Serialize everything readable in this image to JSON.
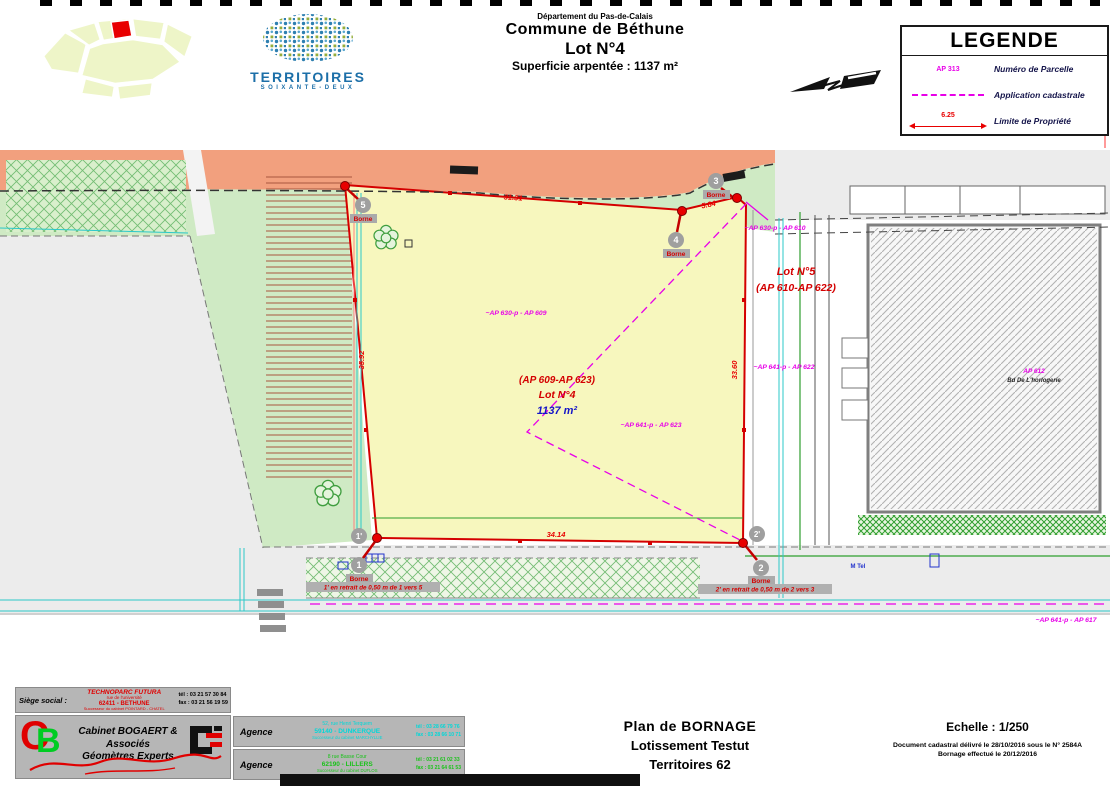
{
  "header": {
    "department": "Département du Pas-de-Calais",
    "commune": "Commune de Béthune",
    "lot": "Lot N°4",
    "area": "Superficie arpentée : 1137 m²"
  },
  "logo": {
    "title": "TERRITOIRES",
    "subtitle": "SOIXANTE-DEUX"
  },
  "legend": {
    "title": "LEGENDE",
    "parcel_symbol": "AP 313",
    "limit_value": "6.25",
    "items": [
      {
        "label": "Numéro de Parcelle"
      },
      {
        "label": "Application cadastrale"
      },
      {
        "label": "Limite de Propriété"
      }
    ]
  },
  "plan": {
    "lot4": {
      "parcels": "(AP 609-AP 623)",
      "name": "Lot N°4",
      "area": "1137 m²"
    },
    "lot5": {
      "name": "Lot N°5",
      "parcels": "(AP 610-AP 622)"
    },
    "labels": {
      "ap630_609": "~AP 630-p - AP 609",
      "ap641_623": "~AP 641-p - AP 623",
      "ap630_610": "~AP 630-p - AP 610",
      "ap641_622": "~AP 641-p - AP 622",
      "ap641_617": "~AP 641-p - AP 617",
      "ap612": "AP 612",
      "building_name": "Bd De L'horlogerie",
      "tel": "M Tel"
    },
    "dimensions": {
      "top": "31.31",
      "top_right": "5.84",
      "right": "33.60",
      "bottom": "34.14",
      "left": "35.92"
    },
    "bornes": {
      "b5": "5",
      "b4": "4",
      "b3": "3",
      "b1": "1",
      "b1p": "1'",
      "b2": "2",
      "b2p": "2'",
      "caption": "Borne",
      "note1": "1' en retrait de 0,50 m de 1 vers 5",
      "note2": "2' en retrait de 0,50 m de 2 vers 3"
    }
  },
  "titleblock": {
    "siege": {
      "label": "Siège social :",
      "name": "TECHNOPARC FUTURA",
      "street": "rue de l'université",
      "city": "62411 - BETHUNE",
      "successor": "Successeur du cabinet POINTARD - CHATEL",
      "tel": "tél : 03 21 57 30 84",
      "fax": "fax : 03 21 56 19 59"
    },
    "cabinet": {
      "name": "Cabinet BOGAERT & Associés",
      "subtitle": "Géomètres Experts"
    },
    "agences": [
      {
        "label": "Agence",
        "street": "52, rue Henri Terquem",
        "city": "59140 - DUNKERQUE",
        "successor": "Successeur du cabinet MARCHYLLIE",
        "tel": "tél : 03 28 66 79 76",
        "fax": "fax : 03 28 66 10 71"
      },
      {
        "label": "Agence",
        "street": "8 rue Basse Cour",
        "city": "62190 - LILLERS",
        "successor": "Successeur du cabinet DUFLOS",
        "tel": "tél : 03 21 61 02 33",
        "fax": "fax : 03 21 64 61 53"
      }
    ],
    "doc": {
      "title1": "Plan de BORNAGE",
      "title2": "Lotissement Testut",
      "title3": "Territoires 62",
      "scale": "Echelle : 1/250",
      "cadastral": "Document cadastral délivré le 28/10/2016 sous le N° 2584A",
      "bornage": "Bornage effectué le 20/12/2016"
    }
  }
}
